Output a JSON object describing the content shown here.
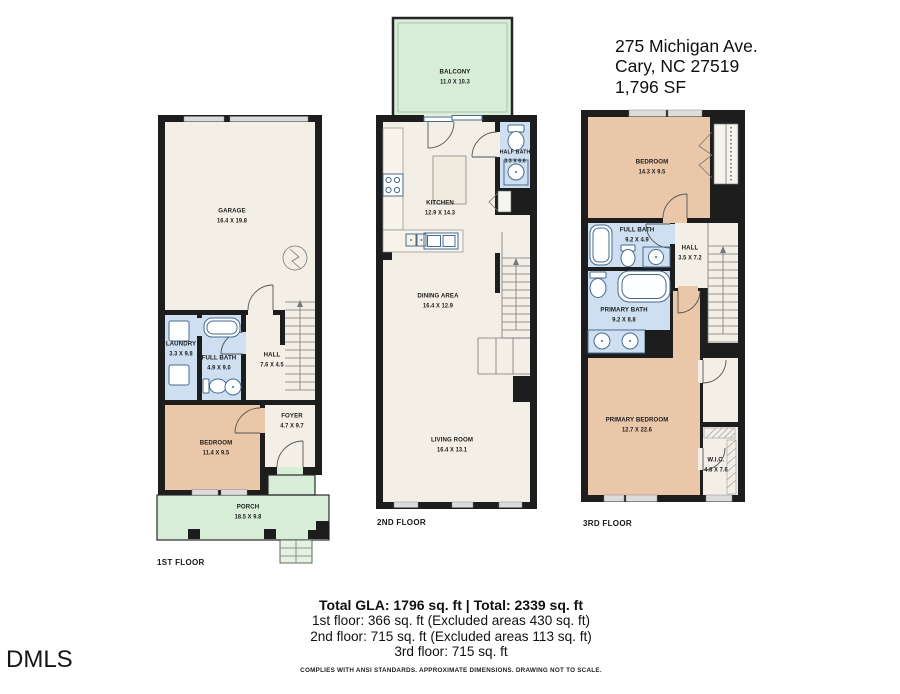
{
  "address": {
    "line1": "275 Michigan Ave.",
    "line2": "Cary, NC 27519",
    "line3": "1,796 SF"
  },
  "branding": {
    "logo": "DMLS"
  },
  "floors": {
    "first": {
      "label": "1ST FLOOR",
      "garage": {
        "name": "GARAGE",
        "dims": "16.4 X 19.8"
      },
      "laundry": {
        "name": "LAUNDRY",
        "dims": "3.3 X 9.8"
      },
      "full_bath": {
        "name": "FULL BATH",
        "dims": "4.9 X 9.0"
      },
      "hall": {
        "name": "HALL",
        "dims": "7.6 X 4.5"
      },
      "foyer": {
        "name": "FOYER",
        "dims": "4.7 X 9.7"
      },
      "bedroom": {
        "name": "BEDROOM",
        "dims": "11.4 X 9.5"
      },
      "porch": {
        "name": "PORCH",
        "dims": "18.5 X 9.8"
      }
    },
    "second": {
      "label": "2ND FLOOR",
      "balcony": {
        "name": "BALCONY",
        "dims": "11.0 X 10.3"
      },
      "kitchen": {
        "name": "KITCHEN",
        "dims": "12.9 X 14.3"
      },
      "half_bath": {
        "name": "HALF BATH",
        "dims": "3.3 X 6.6"
      },
      "dining": {
        "name": "DINING AREA",
        "dims": "16.4 X 12.9"
      },
      "living": {
        "name": "LIVING ROOM",
        "dims": "16.4 X 13.1"
      }
    },
    "third": {
      "label": "3RD FLOOR",
      "bedroom": {
        "name": "BEDROOM",
        "dims": "14.3 X 9.5"
      },
      "full_bath": {
        "name": "FULL BATH",
        "dims": "9.2 X 4.9"
      },
      "hall": {
        "name": "HALL",
        "dims": "3.5 X 7.2"
      },
      "primary_bath": {
        "name": "PRIMARY BATH",
        "dims": "9.2 X 8.8"
      },
      "primary_bedroom": {
        "name": "PRIMARY BEDROOM",
        "dims": "12.7 X 22.6"
      },
      "wic": {
        "name": "W.I.C.",
        "dims": "4.8 X 7.6"
      }
    }
  },
  "summary": {
    "total": "Total GLA: 1796 sq. ft | Total: 2339 sq. ft",
    "floor1": "1st floor: 366 sq. ft (Excluded areas 430 sq. ft)",
    "floor2": "2nd floor: 715 sq. ft (Excluded areas 113 sq. ft)",
    "floor3": "3rd floor: 715 sq. ft",
    "disclaimer": "COMPLIES WITH ANSI STANDARDS. APPROXIMATE DIMENSIONS. DRAWING NOT TO SCALE."
  },
  "colors": {
    "wall": "#1d1d1d",
    "interior": "#f4efe6",
    "bath": "#cddff0",
    "bedroom": "#eac7a8",
    "outdoor": "#d8edd8",
    "steps": "#e4f2e2",
    "window": "#dcdcdc",
    "fixture": "#4a6b8f"
  }
}
